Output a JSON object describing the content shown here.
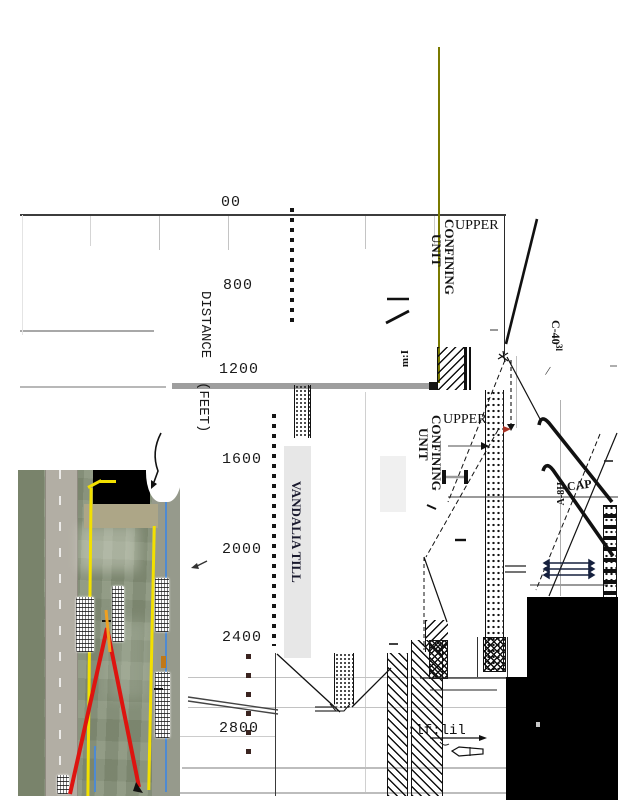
{
  "figure": {
    "description": "rotated geological cross-section scan with aerial photo inset",
    "axis": {
      "label_line1": "DISTANCE",
      "label_line2": "(FEET)",
      "ticks": [
        "00",
        "800",
        "1200",
        "1600",
        "2000",
        "2400",
        "2800"
      ]
    },
    "labels": {
      "upper1_word1": "UPPER",
      "upper1_word2": "CONFINING",
      "upper1_word3": "UNIT",
      "upper2_word1": "UPPER",
      "upper2_word2": "CONFINING",
      "upper2_word3": "UNIT",
      "vandalia_till": "VANDALIA TILL",
      "well_c40": "C-40",
      "well_c40_sub": "3l",
      "slash": "/",
      "cap": "CAP",
      "a8h": "A-8H",
      "mark_mi": "m:I",
      "mark_lf": ":lf:lil"
    },
    "colors": {
      "olive_line": "#7a7a00",
      "red_route": "#dd1410",
      "yellow_boundary": "#f2e000",
      "blue_line": "#4e8ad2",
      "black_mask": "#000000"
    }
  }
}
